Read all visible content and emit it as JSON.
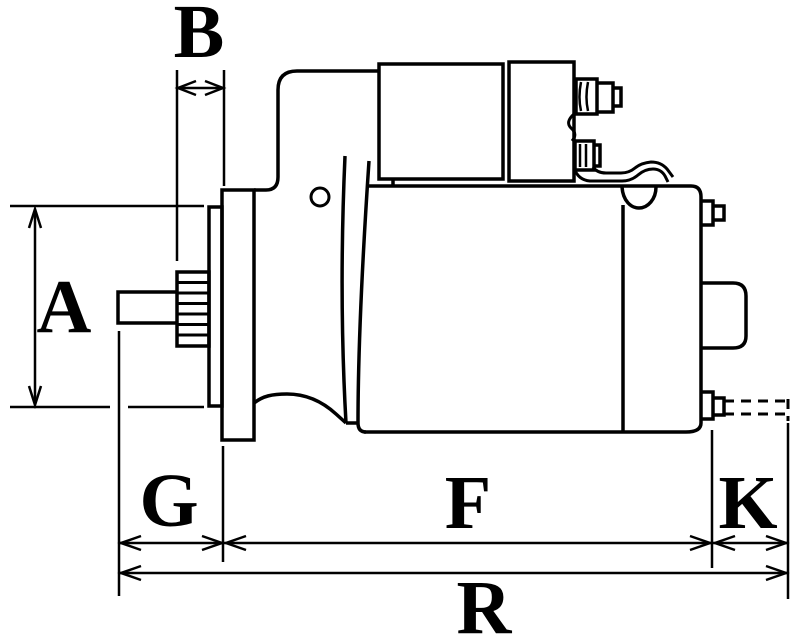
{
  "drawing": {
    "dimension_labels": {
      "A": "A",
      "B": "B",
      "G": "G",
      "F": "F",
      "K": "K",
      "R": "R"
    },
    "colors": {
      "line": "#000000",
      "background": "#ffffff"
    }
  }
}
